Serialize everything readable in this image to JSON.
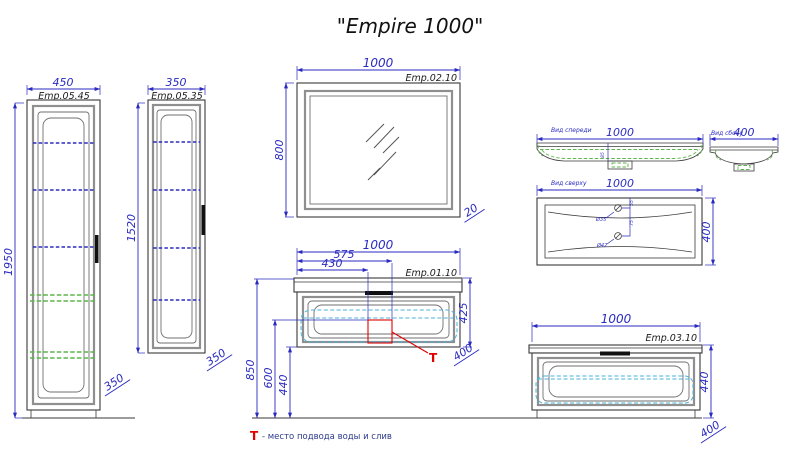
{
  "title": "\"Empire 1000\"",
  "legend": {
    "marker": "T",
    "text": "- место подвода воды и слив"
  },
  "tall_cabinet_450": {
    "code": "Emp.05.45",
    "width": "450",
    "height": "1950",
    "depth": "350"
  },
  "tall_cabinet_350": {
    "code": "Emp.05.35",
    "width": "350",
    "height": "1520",
    "depth": "350"
  },
  "mirror": {
    "code": "Emp.02.10",
    "width": "1000",
    "height": "800",
    "depth": "20"
  },
  "vanity": {
    "code": "Emp.01.10",
    "width": "1000",
    "dim_575": "575",
    "dim_430": "430",
    "front_height": "425",
    "dim_850": "850",
    "dim_600": "600",
    "dim_440": "440",
    "depth": "400",
    "t_marker": "T"
  },
  "washbasin": {
    "front_view_label": "Вид спереди",
    "side_view_label": "Вид сбоку",
    "top_view_label": "Вид сверху",
    "front_width": "1000",
    "side_depth": "400",
    "top_width": "1000",
    "top_depth": "400",
    "basin_height": "85",
    "faucet_hole": "Ø35",
    "drain_hole": "Ø42",
    "faucet_offset": "55",
    "holes_distance": "75"
  },
  "base_cabinet": {
    "code": "Emp.03.10",
    "width": "1000",
    "height": "440",
    "depth": "400"
  }
}
